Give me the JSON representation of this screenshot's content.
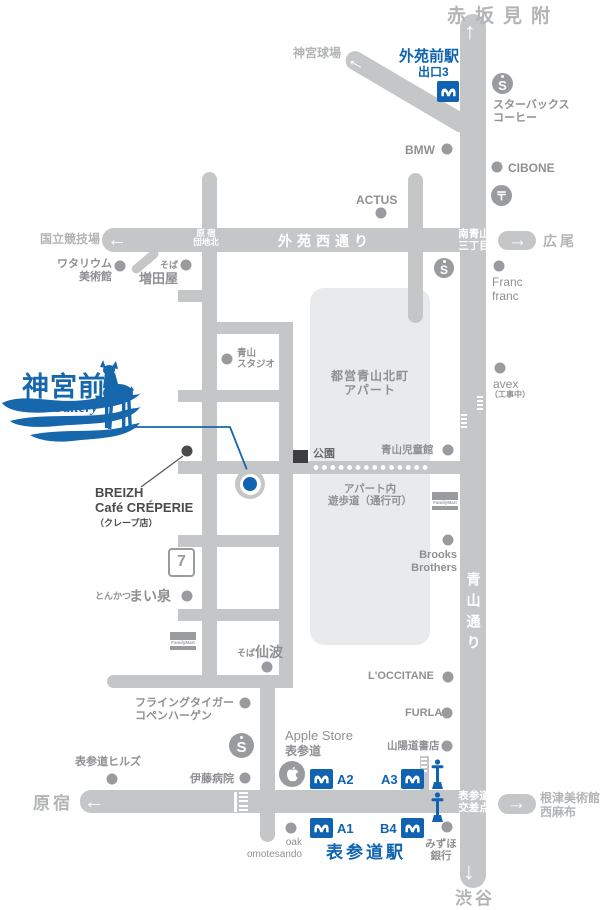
{
  "logo": {
    "title": "神宮前",
    "subtitle": "Gallery"
  },
  "destinations": {
    "akasakamitsuke": "赤坂見附",
    "jingu_stadium": "神宮球場",
    "national_stadium": "国立競技場",
    "hiroo": "広尾",
    "harajuku": "原宿",
    "nezu_museum": "根津美術館",
    "nishiazabu": "西麻布",
    "shibuya": "渋谷"
  },
  "roads": {
    "gaien_nishi_dori": "外苑西通り",
    "aoyama_dori": "青山通り",
    "harajuku_danchi_line1": "原 宿",
    "harajuku_danchi_line2": "団地北",
    "minami_aoyama_line1": "南青山",
    "minami_aoyama_line2": "三丁目",
    "kosaten_line1": "表参道",
    "kosaten_line2": "交差点"
  },
  "stations": {
    "gaienmae": {
      "name": "外苑前駅",
      "exit": "出口3"
    },
    "omotesando": {
      "name": "表参道駅",
      "exit_a1": "A1",
      "exit_a2": "A2",
      "exit_a3": "A3",
      "exit_b4": "B4"
    }
  },
  "pois": {
    "starbucks_line1": "スターバックス",
    "starbucks_line2": "コーヒー",
    "bmw": "BMW",
    "cibone": "CIBONE",
    "actus": "ACTUS",
    "watarium_line1": "ワタリウム",
    "watarium_line2": "美術館",
    "masudaya_prefix": "そば",
    "masudaya": "増田屋",
    "francfranc_line1": "Franc",
    "francfranc_line2": "franc",
    "aoyama_studio_line1": "青山",
    "aoyama_studio_line2": "スタジオ",
    "avex": "avex",
    "avex_note": "（工事中）",
    "apartment_line1": "都営青山北町",
    "apartment_line2": "アパート",
    "park": "公園",
    "jidokan": "青山児童館",
    "promenade_line1": "アパート内",
    "promenade_line2": "遊歩道（通行可）",
    "brooks_line1": "Brooks",
    "brooks_line2": "Brothers",
    "breizh_line1": "BREIZH",
    "breizh_line2": "Café CRÉPERIE",
    "breizh_line3": "（クレープ店）",
    "maisen_prefix": "とんかつ",
    "maisen": "まい泉",
    "semba_prefix": "そば",
    "semba": "仙波",
    "loccitane": "L'OCCITANE",
    "flying_tiger_line1": "フライングタイガー",
    "flying_tiger_line2": "コペンハーゲン",
    "furla": "FURLA",
    "omotesando_hills": "表参道ヒルズ",
    "sanyodo": "山陽道書店",
    "ito_hospital": "伊藤病院",
    "apple_line1": "Apple Store",
    "apple_line2": "表参道",
    "oak_line1": "oak",
    "oak_line2": "omotesando",
    "mizuho_line1": "みずほ",
    "mizuho_line2": "銀行",
    "familymart": "FamilyMart",
    "seven": "7"
  },
  "icons": {
    "arrow_up": "↑",
    "arrow_down": "↓",
    "arrow_left": "←",
    "arrow_right": "→",
    "starbucks_letter": "S",
    "postal_mark": "〒"
  },
  "colors": {
    "road": "#c5c6c8",
    "block": "#e9eaeb",
    "accent_blue": "#0f63b0",
    "logo_blue": "#1767ac"
  }
}
